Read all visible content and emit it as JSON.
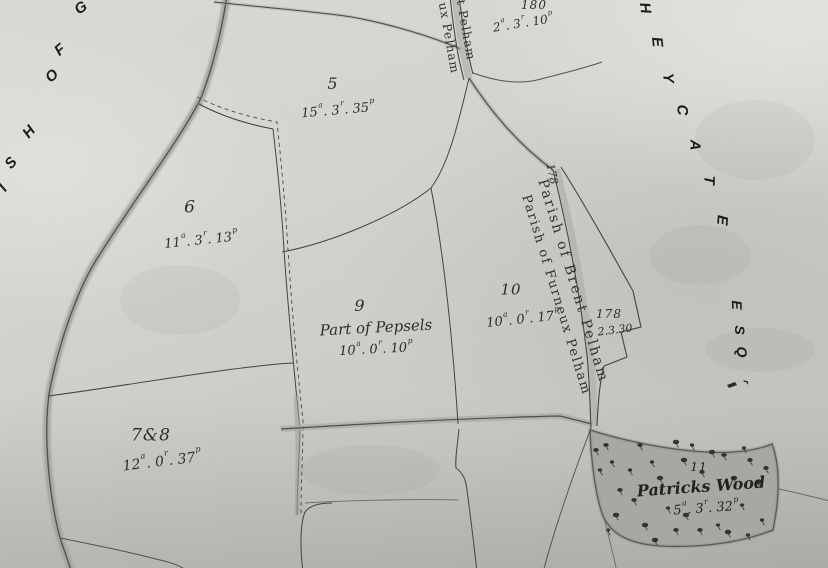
{
  "edge_text": {
    "left_parish_fragment": "ISH OF G",
    "right_owner_fragment": "HEYCATE",
    "right_owner_suffix": "ESQr"
  },
  "boundary_labels": {
    "brent": "Parish of Brent Pelham",
    "furneux": "Parish of Furneux Pelham",
    "top_fragment_left": "ux Pelham",
    "top_fragment_right": "t Pelham",
    "road_number_rotated": "178"
  },
  "parcels": {
    "p5": {
      "number": "5",
      "area": {
        "a": "15",
        "r": "3",
        "p": "35"
      }
    },
    "p6": {
      "number": "6",
      "area": {
        "a": "11",
        "r": "3",
        "p": "13"
      }
    },
    "p78": {
      "number": "7&8",
      "area": {
        "a": "12",
        "r": "0",
        "p": "37"
      }
    },
    "p9": {
      "number": "9",
      "name": "Part of Pepsels",
      "area": {
        "a": "10",
        "r": "0",
        "p": "10"
      }
    },
    "p10": {
      "number": "10",
      "area": {
        "a": "10",
        "r": "0",
        "p": "17"
      }
    },
    "p178": {
      "number": "178",
      "area_text": "2.3.30"
    },
    "p180": {
      "number": "180",
      "area": {
        "a": "2",
        "r": "3",
        "p": "10"
      }
    },
    "p11_wood": {
      "number": "11",
      "name": "Patricks Wood",
      "area": {
        "a": "5",
        "r": "3",
        "p": "32"
      }
    }
  },
  "colors": {
    "paper": "#d6d5d1",
    "ink": "#2e2d29",
    "stamp_ink": "#1b1b19",
    "wood_fill": "#a8a7a1",
    "boundary_shade": "#9b9a94"
  }
}
